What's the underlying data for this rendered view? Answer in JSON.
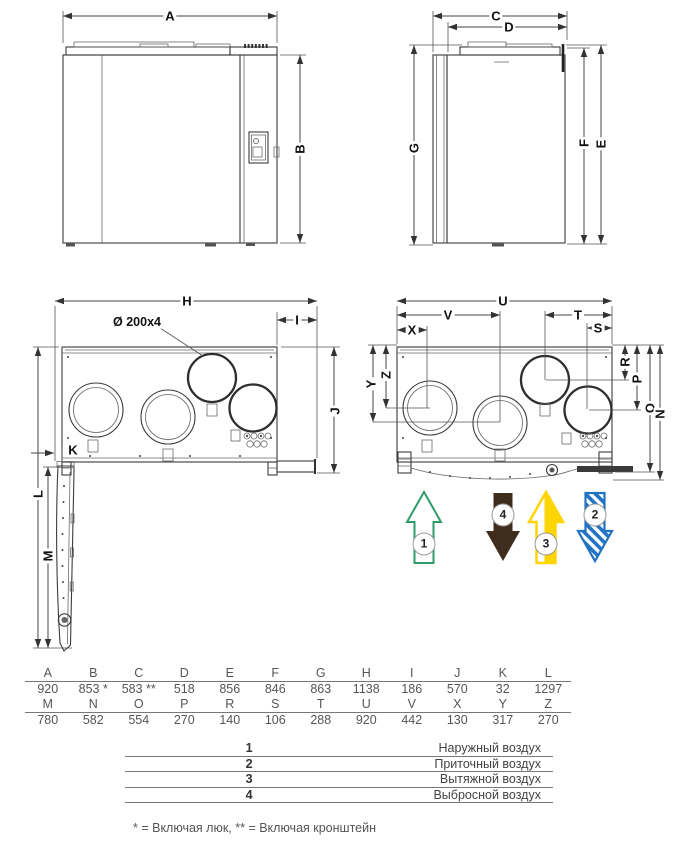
{
  "drawing": {
    "dim_labels": {
      "A": "A",
      "B": "B",
      "C": "C",
      "D": "D",
      "E": "E",
      "F": "F",
      "G": "G",
      "H": "H",
      "I": "I",
      "J": "J",
      "K": "K",
      "L": "L",
      "M": "M",
      "N": "N",
      "O": "O",
      "P": "P",
      "R": "R",
      "S": "S",
      "T": "T",
      "U": "U",
      "V": "V",
      "X": "X",
      "Y": "Y",
      "Z": "Z"
    },
    "duct_label": "Ø 200x4"
  },
  "arrows": [
    {
      "num": "1",
      "color": "#2E9B68",
      "direction": "up",
      "style": "outline"
    },
    {
      "num": "4",
      "color": "#3E2C1C",
      "direction": "down",
      "style": "solid"
    },
    {
      "num": "3",
      "color": "#FFD500",
      "direction": "up",
      "style": "half-fill"
    },
    {
      "num": "2",
      "color": "#2173C3",
      "direction": "down",
      "style": "hatched"
    }
  ],
  "dim_table": {
    "rows": [
      [
        "A",
        "B",
        "C",
        "D",
        "E",
        "F",
        "G",
        "H",
        "I",
        "J",
        "K",
        "L"
      ],
      [
        "920",
        "853 *",
        "583 **",
        "518",
        "856",
        "846",
        "863",
        "1138",
        "186",
        "570",
        "32",
        "1297"
      ],
      [
        "M",
        "N",
        "O",
        "P",
        "R",
        "S",
        "T",
        "U",
        "V",
        "X",
        "Y",
        "Z"
      ],
      [
        "780",
        "582",
        "554",
        "270",
        "140",
        "106",
        "288",
        "920",
        "442",
        "130",
        "317",
        "270"
      ]
    ]
  },
  "legend": {
    "rows": [
      {
        "num": "1",
        "label": "Наружный воздух"
      },
      {
        "num": "2",
        "label": "Приточный воздух"
      },
      {
        "num": "3",
        "label": "Вытяжной воздух"
      },
      {
        "num": "4",
        "label": "Выбросной воздух"
      }
    ]
  },
  "footnote": "* = Включая люк, ** = Включая кронштейн"
}
